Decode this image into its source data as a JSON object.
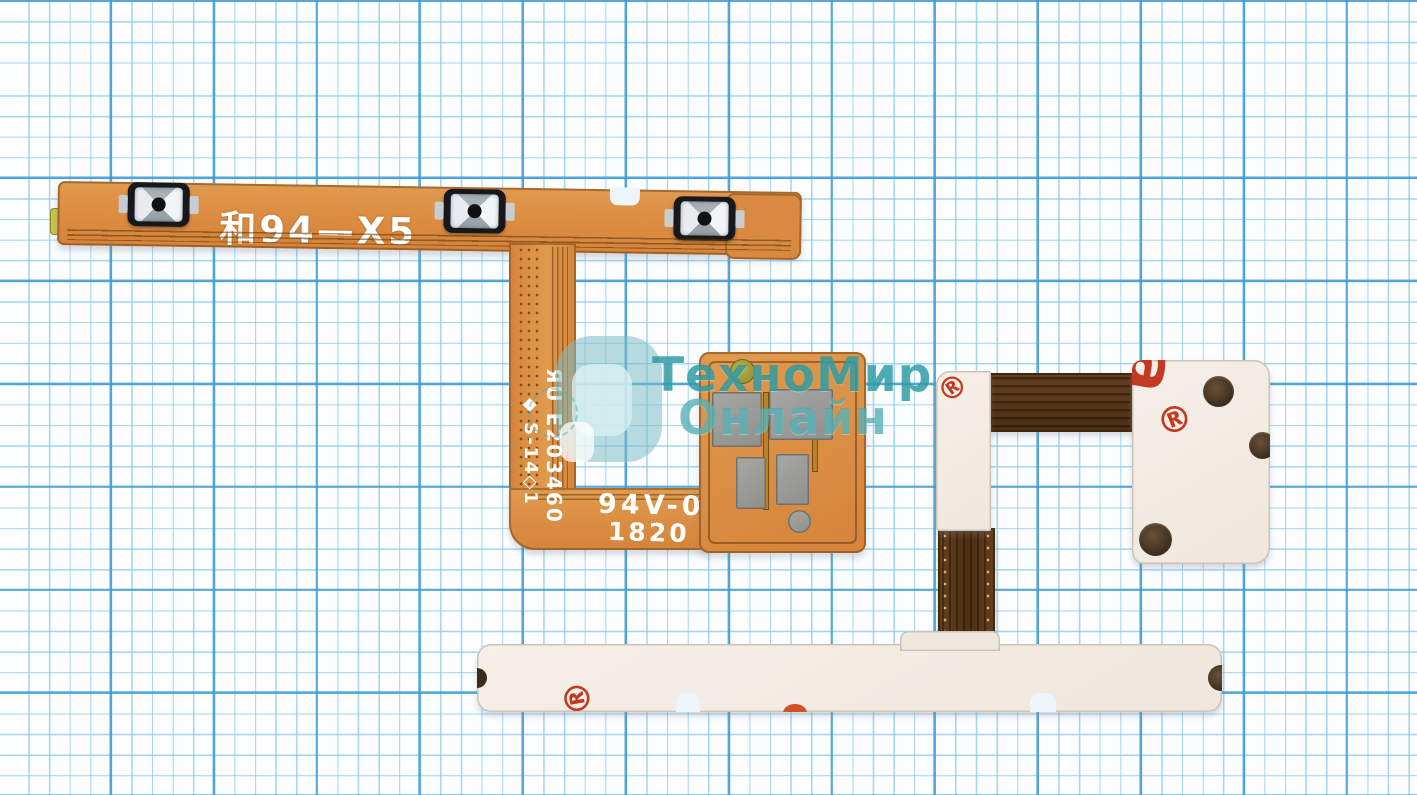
{
  "scene": {
    "description": "product photo of phone volume/power flex cables on graph paper",
    "paper_color": "#fbfdff",
    "grid_minor_color": "#8ac8ec",
    "grid_major_color": "#3e9ad2"
  },
  "watermark": {
    "line1": "ТехноМир",
    "line2": "Онлайн",
    "color": "#1e949c"
  },
  "flex_cable": {
    "model_text": "和94—X5",
    "cert_vertical_1": "ЯU E203460",
    "cert_vertical_2": "◆ S-14◇1",
    "flammability_text": "94V-0",
    "date_code": "1820",
    "body_color": "#dd8f44",
    "trace_color": "#7a4a1a",
    "button_count": 3
  },
  "backing_parts": {
    "registered_mark": "®",
    "partial_mark": "а",
    "mark_color": "#c23a22",
    "plate_color": "#f2ece4",
    "ribbon_color": "#5d3a1d"
  }
}
